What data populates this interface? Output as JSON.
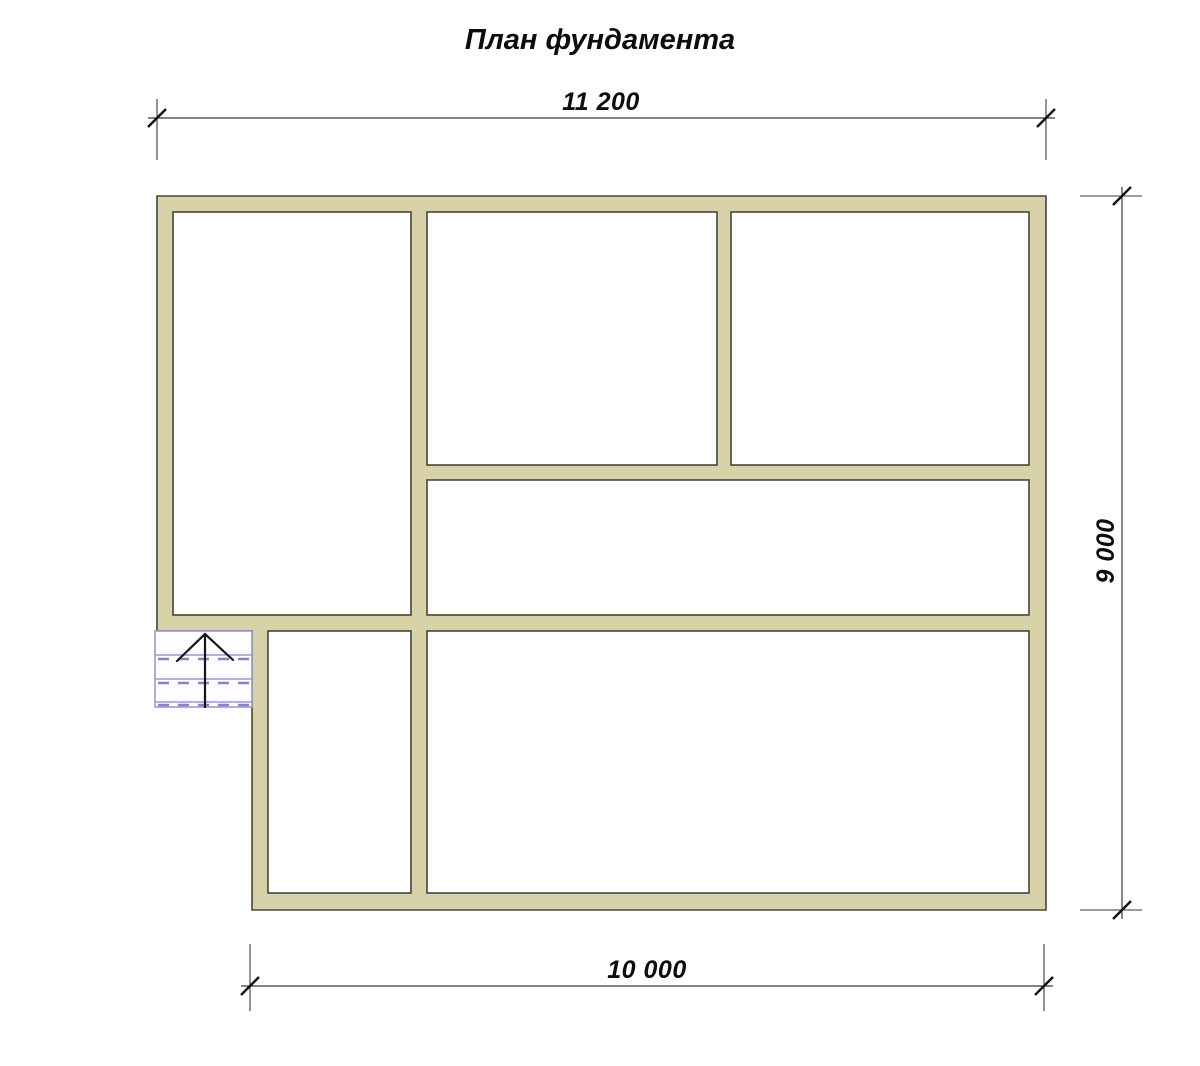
{
  "title": "План фундамента",
  "dimensions": {
    "top": "11 200",
    "right": "9 000",
    "bottom": "10 000"
  },
  "colors": {
    "wall_fill": "#d9d1a8",
    "wall_outline": "#45453a",
    "dimension_line": "#3a3a3a",
    "stair_line": "#9a9ad0",
    "background": "#ffffff"
  }
}
